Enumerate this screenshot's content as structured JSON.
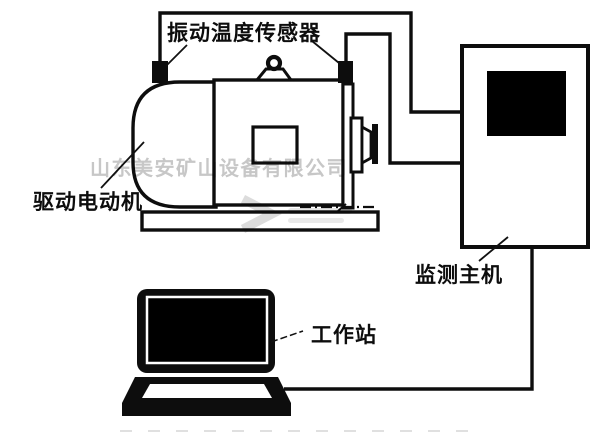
{
  "colors": {
    "background": "#ffffff",
    "line": "#0d0d0d",
    "fill_black": "#000000",
    "watermark_gray": "#c7c7c7"
  },
  "labels": {
    "sensor": "振动温度传感器",
    "motor": "驱动电动机",
    "host": "监测主机",
    "workstation": "工作站"
  },
  "watermark": {
    "text": "山东美安矿山设备有限公司"
  },
  "components": [
    {
      "name": "drive-motor"
    },
    {
      "name": "vibration-temperature-sensor-left"
    },
    {
      "name": "vibration-temperature-sensor-right"
    },
    {
      "name": "shaft-coupling"
    },
    {
      "name": "monitoring-host"
    },
    {
      "name": "workstation-laptop"
    },
    {
      "name": "sensor-cable-left"
    },
    {
      "name": "sensor-cable-right"
    },
    {
      "name": "host-to-workstation-cable"
    }
  ]
}
